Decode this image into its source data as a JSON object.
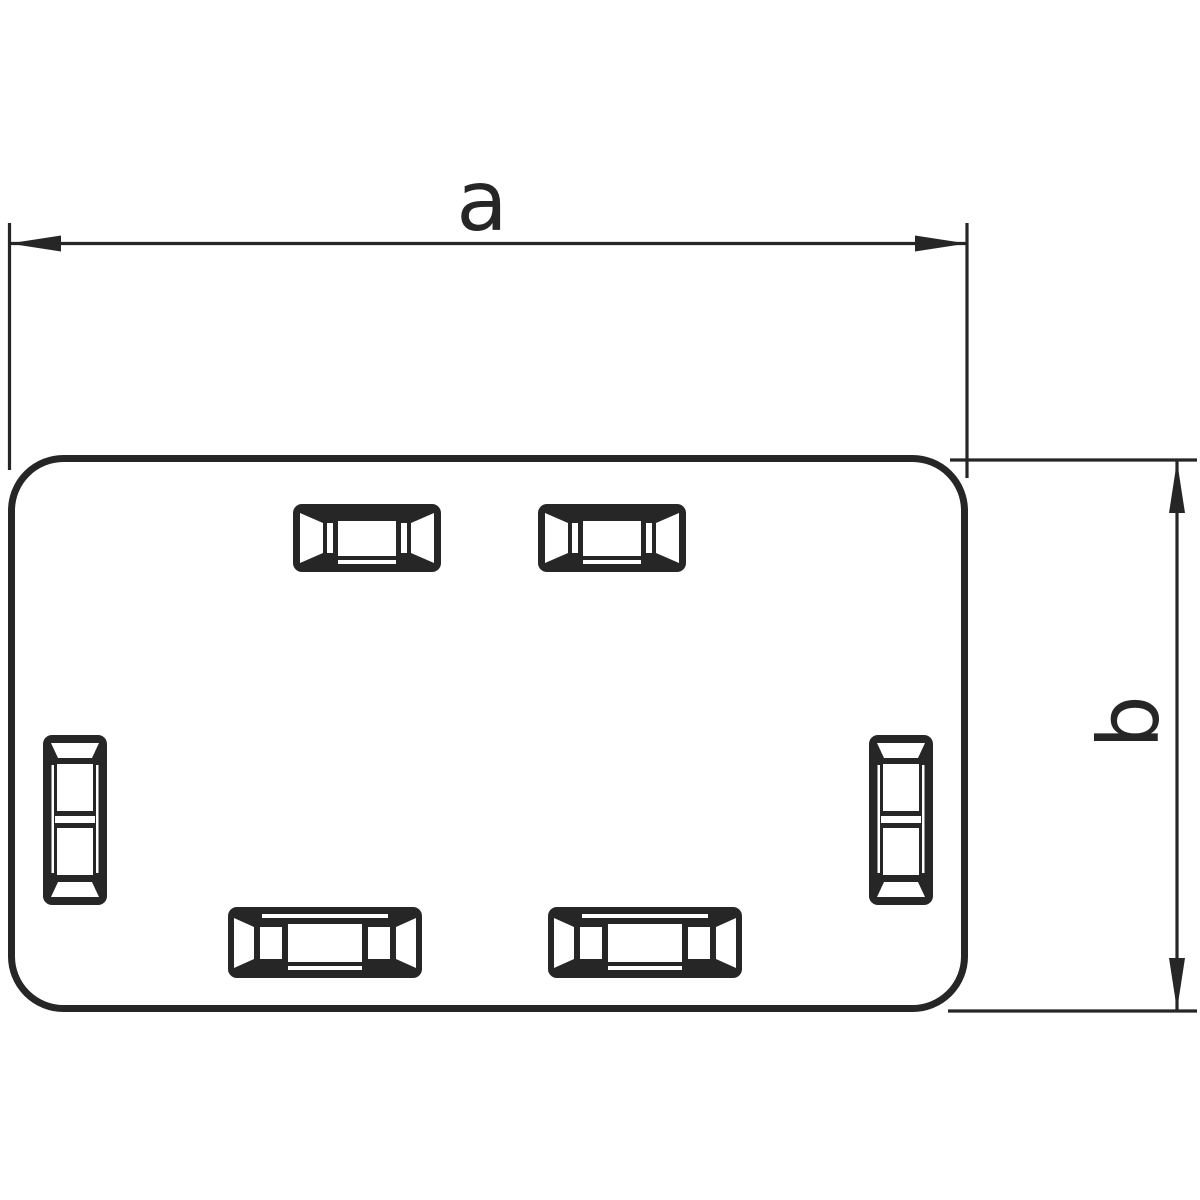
{
  "theme": {
    "ink": "#262626",
    "paper": "#ffffff"
  },
  "diagram": {
    "kind": "engineering-line-drawing",
    "part": {
      "shape": "rounded-rectangle face plate",
      "slots": {
        "top": 2,
        "bottom": 2,
        "left-side": 1,
        "right-side": 1
      }
    },
    "dimensions": [
      {
        "id": "a",
        "label": "a",
        "orientation": "horizontal",
        "measures": "overall width"
      },
      {
        "id": "b",
        "label": "b",
        "orientation": "vertical",
        "measures": "overall height"
      }
    ]
  }
}
